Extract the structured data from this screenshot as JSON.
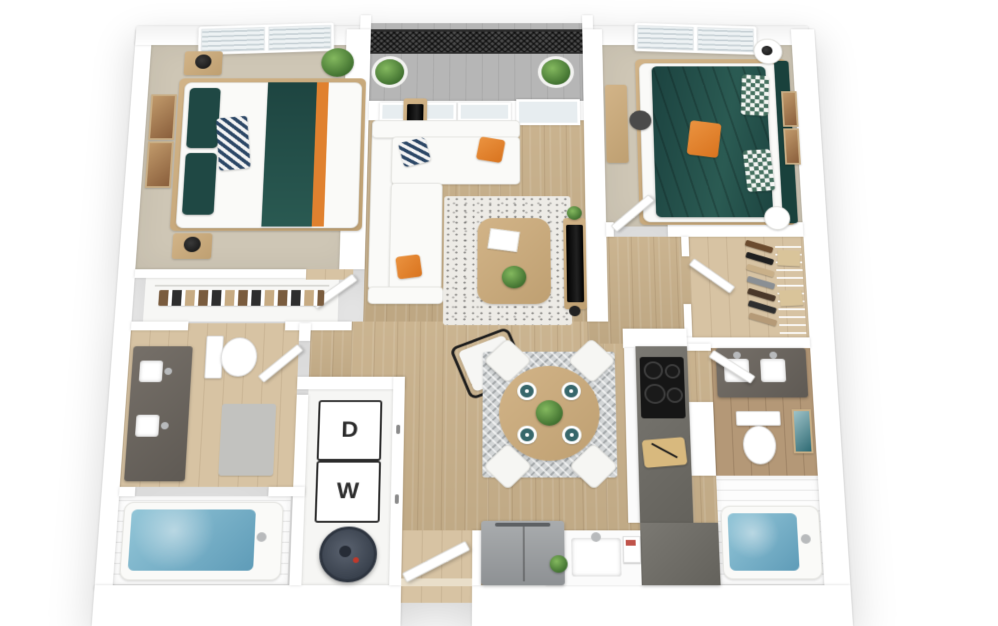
{
  "floorplan": {
    "title": "Two-bedroom two-bath apartment 3D floor plan",
    "laundry": {
      "dryer_label": "D",
      "washer_label": "W"
    },
    "rooms": [
      "bedroom-1",
      "bedroom-2",
      "living-room",
      "dining-area",
      "kitchen",
      "bathroom-1",
      "bathroom-2",
      "walk-in-closet",
      "reach-in-closet",
      "laundry-closet",
      "balcony",
      "entry"
    ],
    "colors": {
      "wall": "#ffffff",
      "wood_floor": "#c8b08a",
      "carpet": "#cec6b5",
      "accent_teal": "#1f4540",
      "accent_orange": "#e0812f",
      "tub_water": "#7cb3c9",
      "vanity_gray": "#6e6862",
      "balcony_railing": "#3a3a3a",
      "stove_black": "#161616"
    }
  }
}
